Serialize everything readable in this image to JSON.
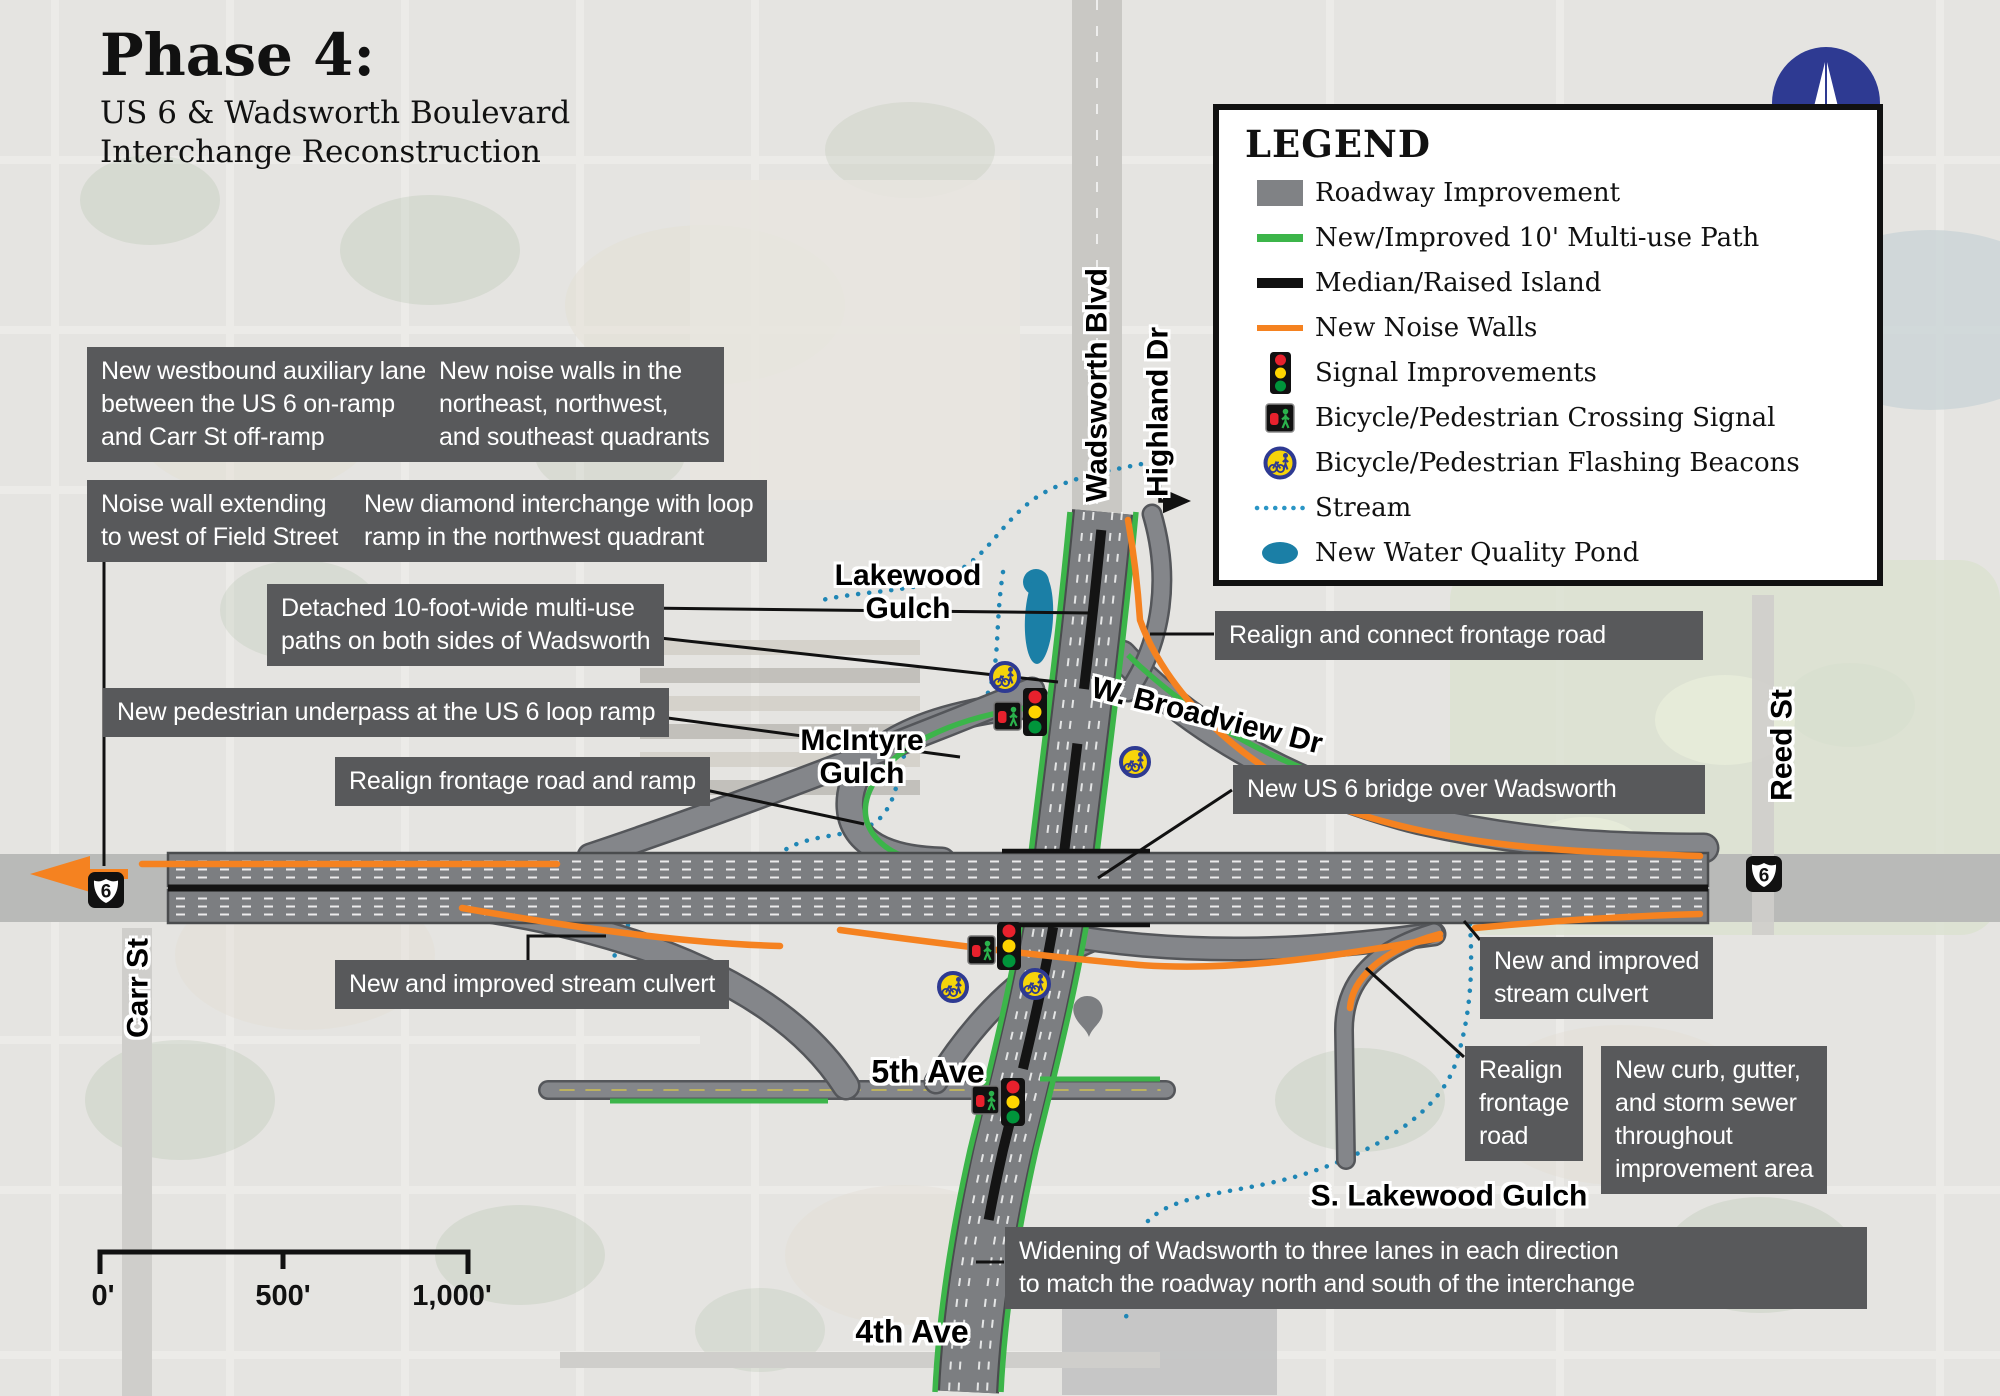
{
  "title": {
    "phase": "Phase 4:",
    "subtitle": "US 6 & Wadsworth Boulevard\nInterchange Reconstruction"
  },
  "north_label": "N",
  "legend": {
    "title": "LEGEND",
    "items": [
      {
        "icon": "roadway-swatch",
        "label": "Roadway Improvement"
      },
      {
        "icon": "multiuse-path-line",
        "label": "New/Improved 10' Multi-use Path"
      },
      {
        "icon": "median-line",
        "label": "Median/Raised Island"
      },
      {
        "icon": "noise-wall-line",
        "label": "New Noise Walls"
      },
      {
        "icon": "traffic-signal",
        "label": "Signal Improvements"
      },
      {
        "icon": "crossing-signal",
        "label": "Bicycle/Pedestrian Crossing Signal"
      },
      {
        "icon": "flashing-beacon",
        "label": "Bicycle/Pedestrian Flashing Beacons"
      },
      {
        "icon": "stream-dots",
        "label": "Stream"
      },
      {
        "icon": "pond",
        "label": "New Water Quality Pond"
      }
    ]
  },
  "callouts": [
    {
      "text": "New westbound auxiliary lane\nbetween the US 6 on-ramp\nand Carr St off-ramp"
    },
    {
      "text": "New noise walls in the\nnortheast, northwest,\nand southeast quadrants"
    },
    {
      "text": "Noise wall extending\nto west of Field Street"
    },
    {
      "text": "New diamond interchange with loop\nramp in the northwest quadrant"
    },
    {
      "text": "Detached 10-foot-wide multi-use\npaths on both sides of Wadsworth"
    },
    {
      "text": "New pedestrian underpass at the US 6 loop ramp"
    },
    {
      "text": "Realign frontage road and ramp"
    },
    {
      "text": "Realign and connect frontage road"
    },
    {
      "text": "New US 6 bridge over Wadsworth"
    },
    {
      "text": "New and improved stream culvert"
    },
    {
      "text": "New and improved\nstream culvert"
    },
    {
      "text": "Realign\nfrontage\nroad"
    },
    {
      "text": "New curb, gutter,\nand storm sewer\nthroughout\nimprovement area"
    },
    {
      "text": "Widening of Wadsworth to three lanes in each direction\nto match the roadway north and south of the interchange"
    }
  ],
  "map_labels": {
    "wadsworth_blvd": "Wadsworth Blvd",
    "highland_dr": "Highland Dr",
    "lakewood_gulch": "Lakewood\nGulch",
    "mcintyre_gulch": "McIntyre\nGulch",
    "broadview_dr": "W. Broadview Dr",
    "reed_st": "Reed St",
    "carr_st": "Carr St",
    "fifth_ave": "5th Ave",
    "fourth_ave": "4th Ave",
    "s_lakewood_gulch": "S. Lakewood Gulch",
    "us6_shield": "6"
  },
  "scale_bar": {
    "start": "0'",
    "middle": "500'",
    "end": "1,000'"
  },
  "colors": {
    "roadway_gray": "#808285",
    "path_green": "#3cb54a",
    "median_black": "#111111",
    "noise_orange": "#f58220",
    "stream_blue": "#2a95c5",
    "pond_teal": "#1b7fa6",
    "callout_bg": "#58595b",
    "north_blue": "#2e3a92"
  }
}
